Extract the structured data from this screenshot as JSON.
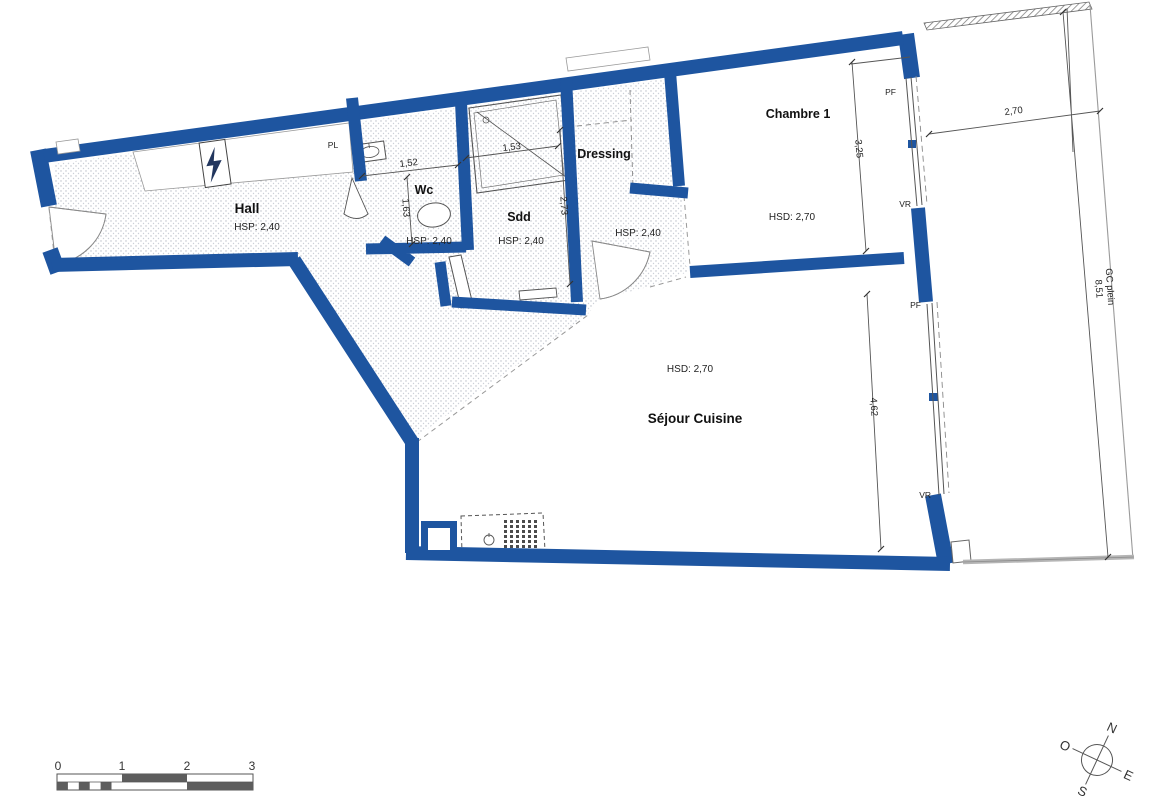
{
  "rooms": {
    "hall": {
      "label": "Hall",
      "height": "HSP: 2,40"
    },
    "closet": {
      "label": "PL"
    },
    "wc": {
      "label": "Wc",
      "height": "HSP: 2,40",
      "width_dim": "1,52",
      "depth_dim": "1,63"
    },
    "sdd": {
      "label": "Sdd",
      "height": "HSP: 2,40",
      "shower_dim": "1,53",
      "depth_dim": "2,73"
    },
    "corridor": {
      "height": "HSP: 2,40"
    },
    "dressing": {
      "label": "Dressing"
    },
    "chambre": {
      "label": "Chambre 1",
      "height": "HSD: 2,70",
      "depth_dim": "3,25"
    },
    "sejour": {
      "label": "Séjour Cuisine",
      "height": "HSD: 2,70",
      "depth_dim": "4,62"
    }
  },
  "facade": {
    "pf_top": "PF",
    "vr_top": "VR",
    "pf_mid": "PF",
    "vr_bottom": "VR"
  },
  "balcony": {
    "width_dim": "2,70",
    "gc_label": "GC plein",
    "gc_value": "8,51"
  },
  "scalebar": {
    "ticks": [
      "0",
      "1",
      "2",
      "3"
    ]
  },
  "compass": {
    "n": "N",
    "e": "E",
    "s": "S",
    "o": "O"
  },
  "colors": {
    "wall": "#1e55a0"
  }
}
